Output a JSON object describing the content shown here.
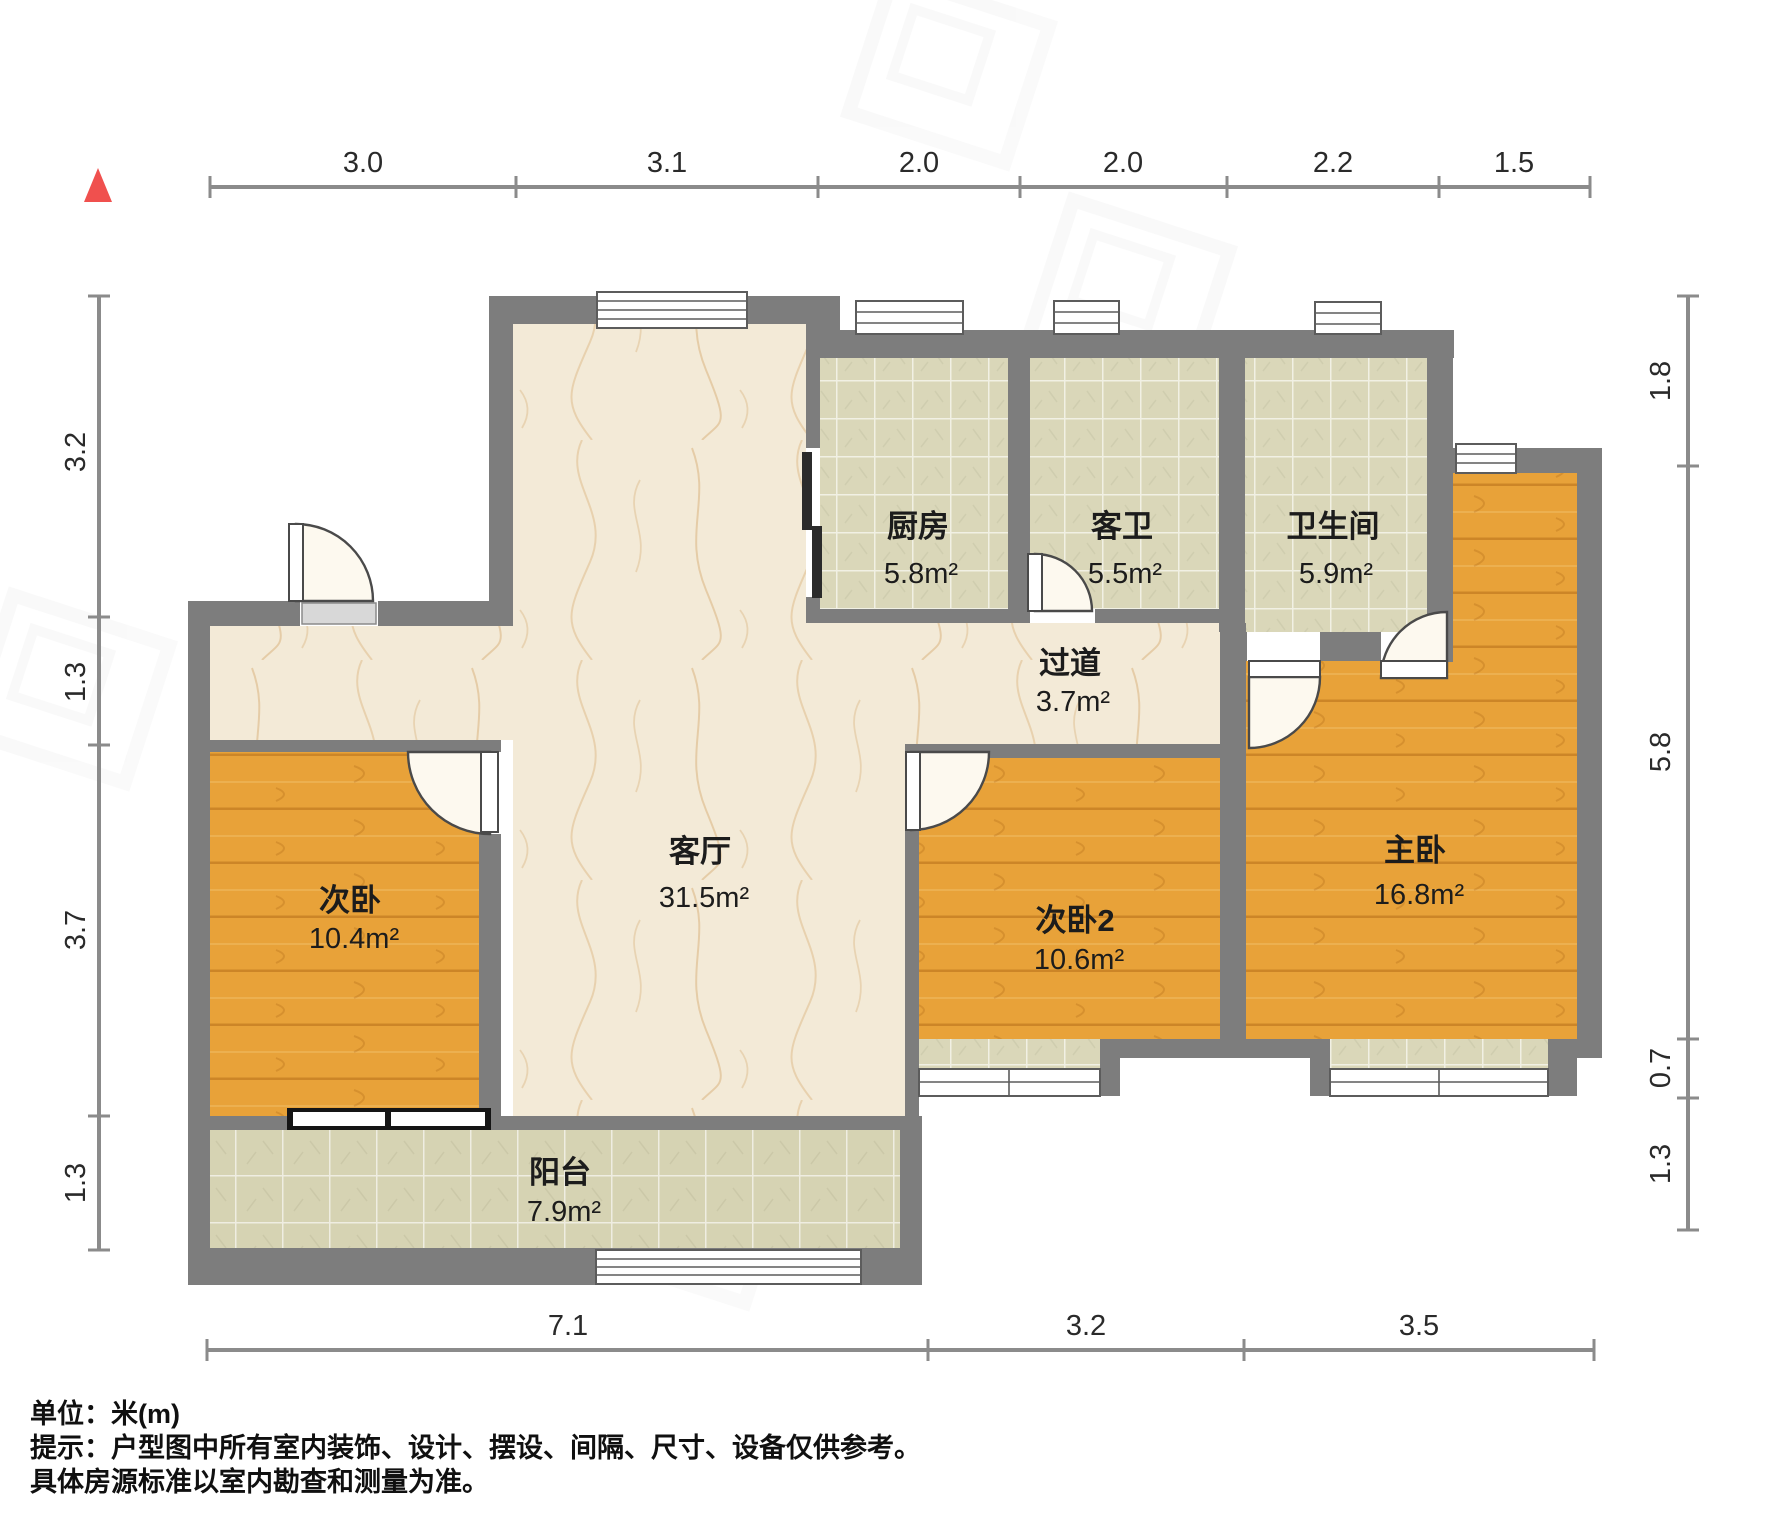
{
  "rooms": {
    "living": {
      "name": "客厅",
      "area": "31.5m²"
    },
    "kitchen": {
      "name": "厨房",
      "area": "5.8m²"
    },
    "guest_bath": {
      "name": "客卫",
      "area": "5.5m²"
    },
    "bathroom": {
      "name": "卫生间",
      "area": "5.9m²"
    },
    "hallway": {
      "name": "过道",
      "area": "3.7m²"
    },
    "bedroom_second": {
      "name": "次卧",
      "area": "10.4m²"
    },
    "bedroom_third": {
      "name": "次卧2",
      "area": "10.6m²"
    },
    "bedroom_master": {
      "name": "主卧",
      "area": "16.8m²"
    },
    "balcony": {
      "name": "阳台",
      "area": "7.9m²"
    }
  },
  "dimensions": {
    "top": {
      "labels": [
        "3.0",
        "3.1",
        "2.0",
        "2.0",
        "2.2",
        "1.5"
      ]
    },
    "bottom": {
      "labels": [
        "7.1",
        "3.2",
        "3.5"
      ]
    },
    "left": {
      "labels": [
        "3.2",
        "1.3",
        "3.7",
        "1.3"
      ]
    },
    "right": {
      "labels": [
        "1.8",
        "5.8",
        "0.7",
        "1.3"
      ]
    }
  },
  "footer": {
    "unit_note": "单位：米(m)",
    "tip_line1": "提示：户型图中所有室内装饰、设计、摆设、间隔、尺寸、设备仅供参考。",
    "tip_line2": "具体房源标准以室内勘查和测量为准。"
  },
  "colors": {
    "wall": "#7d7d7d",
    "wood_floor": "#e8a239",
    "tile_floor": "#dad7b9",
    "marble_floor": "#f3ead7",
    "north_marker": "#f0504e"
  }
}
